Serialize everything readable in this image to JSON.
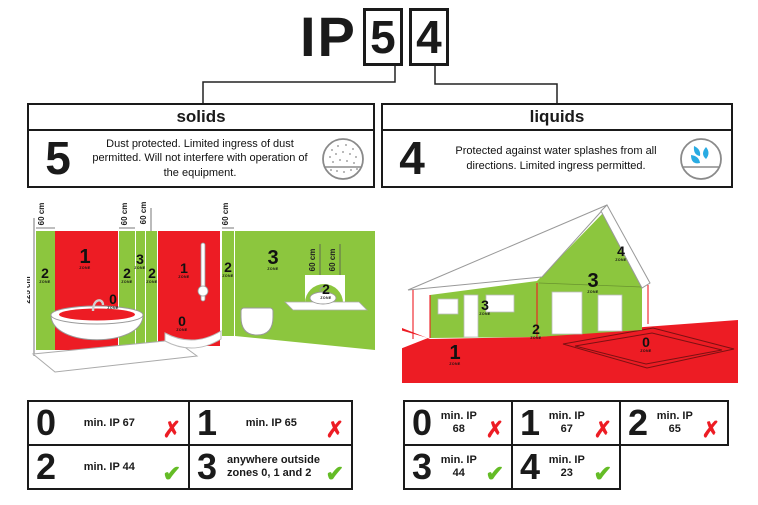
{
  "colors": {
    "red": "#ED1C24",
    "green": "#8CC63E",
    "check_green": "#64BC26",
    "fail_red": "#ED1C24",
    "water_blue": "#29ABE2",
    "outline_gray": "#9a9a9a"
  },
  "header": {
    "prefix": "IP",
    "solids_digit": "5",
    "liquids_digit": "4"
  },
  "panels": {
    "solids": {
      "title": "solids",
      "digit": "5",
      "desc": "Dust protected. Limited ingress of dust permitted. Will not interfere with operation of the equipment.",
      "icon": "dust-circle-icon"
    },
    "liquids": {
      "title": "liquids",
      "digit": "4",
      "desc": "Protected against water splashes from all directions. Limited ingress permitted.",
      "icon": "water-splash-icon"
    }
  },
  "bathroom": {
    "height_label": "225 cm",
    "dist_label": "60 cm",
    "zone_word": "ZONE",
    "zones": {
      "z0": "0",
      "z1": "1",
      "z2": "2",
      "z3": "3"
    }
  },
  "house": {
    "zone_word": "ZONE",
    "zones": {
      "z0": "0",
      "z1": "1",
      "z2": "2",
      "z3": "3",
      "z4": "4"
    }
  },
  "tables": {
    "marks": {
      "fail": "✗",
      "pass": "✔"
    },
    "bathroom": {
      "cells": [
        {
          "digit": "0",
          "text": "min. IP 67",
          "status": "fail"
        },
        {
          "digit": "1",
          "text": "min. IP 65",
          "status": "fail"
        },
        {
          "digit": "2",
          "text": "min. IP 44",
          "status": "pass"
        },
        {
          "digit": "3",
          "text": "anywhere outside zones 0, 1 and 2",
          "status": "pass"
        }
      ]
    },
    "outdoor": {
      "cells": [
        {
          "digit": "0",
          "text": "min. IP 68",
          "status": "fail"
        },
        {
          "digit": "1",
          "text": "min. IP 67",
          "status": "fail"
        },
        {
          "digit": "2",
          "text": "min. IP 65",
          "status": "fail"
        },
        {
          "digit": "3",
          "text": "min. IP 44",
          "status": "pass"
        },
        {
          "digit": "4",
          "text": "min. IP 23",
          "status": "pass"
        }
      ]
    }
  }
}
